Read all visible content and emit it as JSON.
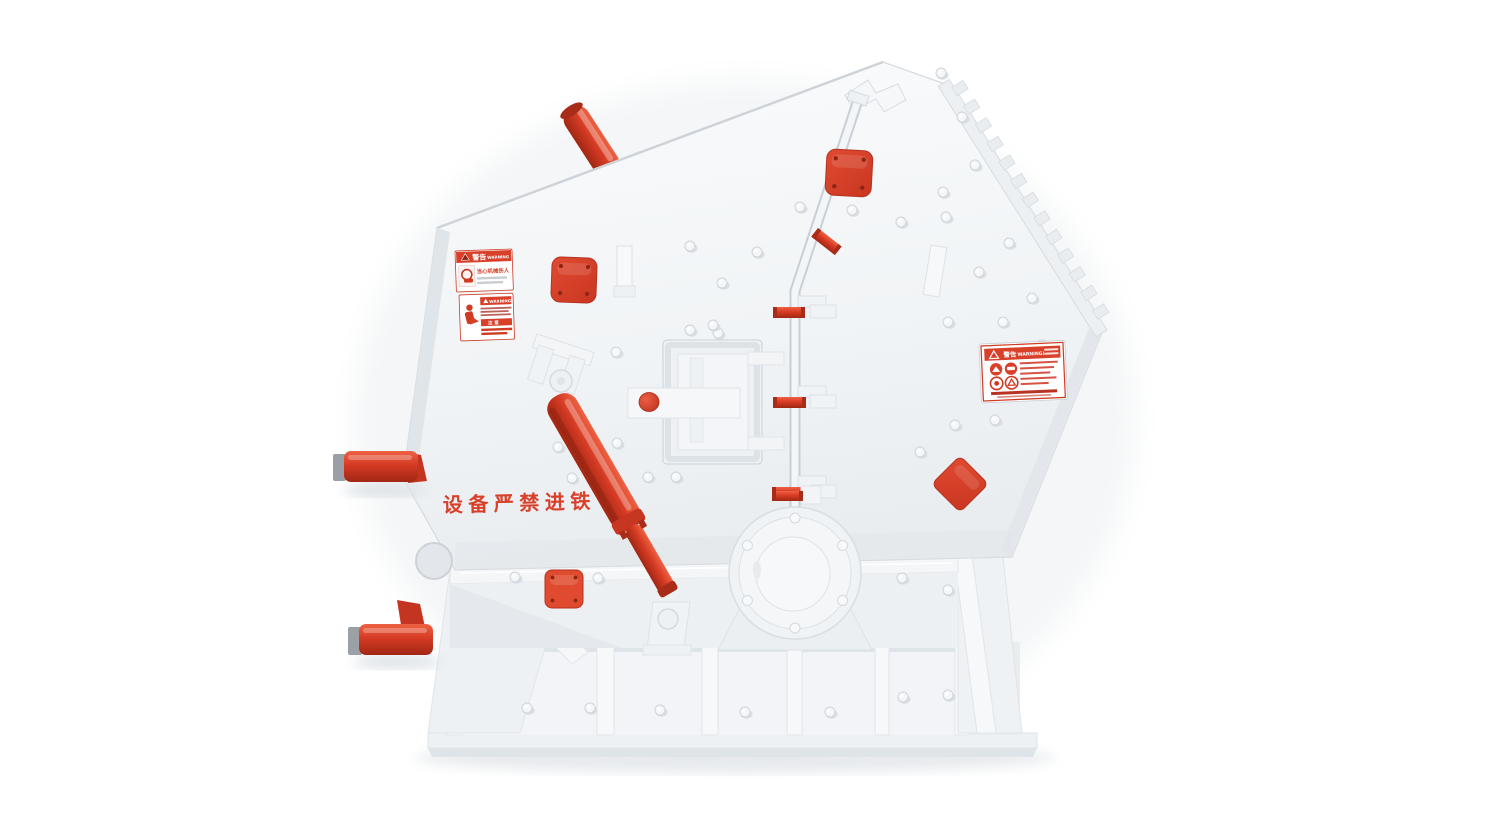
{
  "scene": {
    "type": "3d-product-render",
    "subject": "impact crusher machine, white housing with red accents",
    "background": "#ffffff"
  },
  "colors": {
    "red": "#d8402a",
    "red_bright": "#e4513a",
    "red_dark": "#a82c18",
    "red_deep": "#8f2413",
    "gray_cap": "#9aa0a5",
    "label_red": "#cf3a22",
    "body": "#f2f4f6",
    "body_shade": "#e3e7eb",
    "edge": "#ccd2d8"
  },
  "machine": {
    "slogan": "设备严禁进铁",
    "labels": {
      "small_top": {
        "header_cn": "警告",
        "header_en": "WARNING",
        "title": "当心机械伤人"
      },
      "small_bottom": {
        "header_en": "WARNING",
        "notice_cn": "注 意"
      },
      "large_right": {
        "header_cn": "警告",
        "header_en": "WARNING!"
      }
    },
    "icons": {
      "hazard_triangle": "▲"
    }
  }
}
